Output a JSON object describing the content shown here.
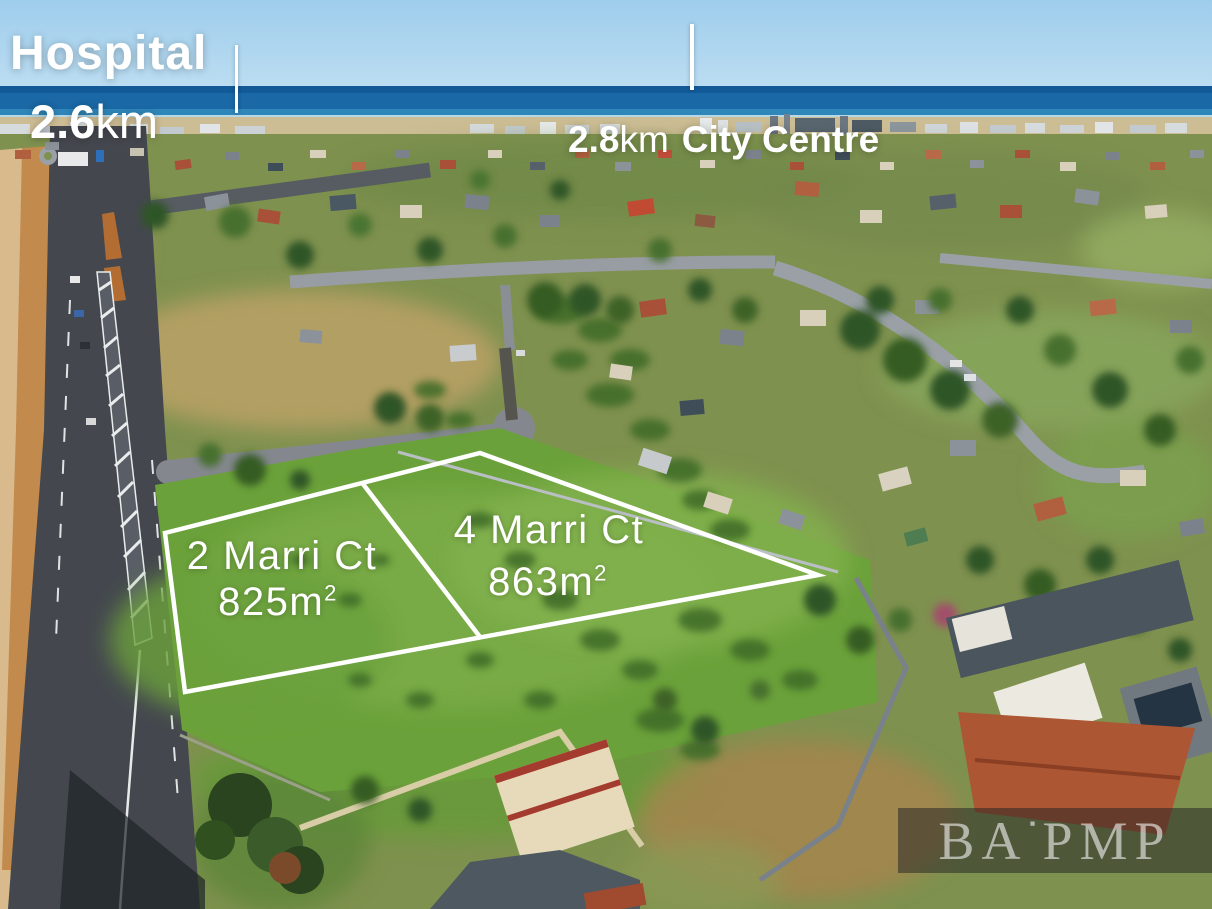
{
  "annotations": {
    "hospital": {
      "title": "Hospital",
      "distance_value": "2.6",
      "distance_unit": "km"
    },
    "city_centre": {
      "distance_value": "2.8",
      "distance_unit": "km",
      "title": "City Centre"
    }
  },
  "lots": {
    "lot2": {
      "name": "2 Marri Ct",
      "area_value": "825",
      "area_unit": "m",
      "area_sup": "2"
    },
    "lot4": {
      "name": "4 Marri Ct",
      "area_value": "863",
      "area_unit": "m",
      "area_sup": "2"
    }
  },
  "watermark": {
    "left": "BA",
    "separator": "▪",
    "right": "PMP"
  },
  "colors": {
    "annotation_text": "#ffffff",
    "boundary_line": "#ffffff",
    "watermark_background": "rgba(30,32,36,0.5)",
    "watermark_text": "rgba(240,240,240,0.62)"
  }
}
